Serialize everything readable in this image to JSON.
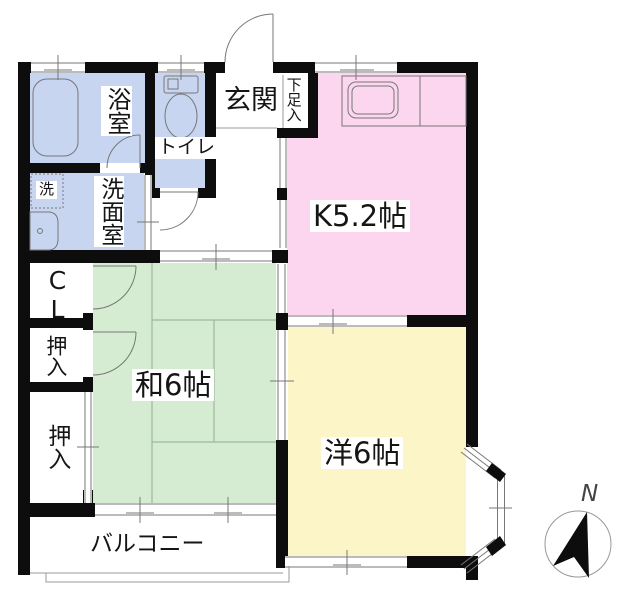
{
  "colors": {
    "wall": "#0d0d0d",
    "wet": "#c8d5f0",
    "kitchen": "#fbd6ee",
    "japanese": "#d6ecd2",
    "western": "#fcf5c8",
    "line": "#777777",
    "thin": "#999999",
    "tatami": "#9cb89c"
  },
  "rooms": {
    "bath": "浴室",
    "washroom": "洗面室",
    "laundry": "洗",
    "toilet": "トイレ",
    "entrance": "玄関",
    "shoe_cabinet": "下足入",
    "kitchen": "K5.2帖",
    "closet": "CL",
    "oshiire_upper": "押入",
    "oshiire_lower": "押入",
    "japanese_room": "和6帖",
    "western_room": "洋6帖",
    "balcony": "バルコニー"
  },
  "compass": {
    "north_label": "N"
  }
}
